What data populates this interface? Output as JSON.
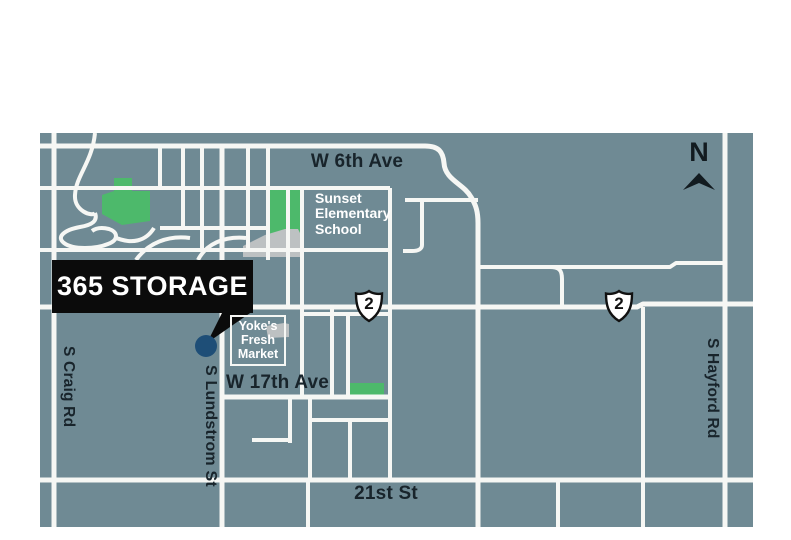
{
  "title": "365 Storage location map",
  "colors": {
    "background": "#6f8a94",
    "road": "#f6f7f4",
    "park_green": "#4db96b",
    "building_gray": "#bdc1c2",
    "marker_blue": "#1e4e77",
    "callout_black": "#0b0b0b",
    "label_dark": "#18242b",
    "label_light": "#ffffff"
  },
  "callout": {
    "label": "365 STORAGE"
  },
  "compass": {
    "label": "N"
  },
  "streets": {
    "w6th_ave": "W 6th Ave",
    "w17th_ave": "W 17th Ave",
    "st_21st": "21st St",
    "craig_rd": "S Craig Rd",
    "lundstrom_st": "S Lundstrom St",
    "hayford_rd": "S Hayford Rd"
  },
  "places": {
    "school": {
      "lines": [
        "Sunset",
        "Elementary",
        "School"
      ]
    },
    "market": {
      "lines": [
        "Yoke's",
        "Fresh",
        "Market"
      ]
    }
  },
  "shields": [
    {
      "route": "2"
    },
    {
      "route": "2"
    }
  ]
}
